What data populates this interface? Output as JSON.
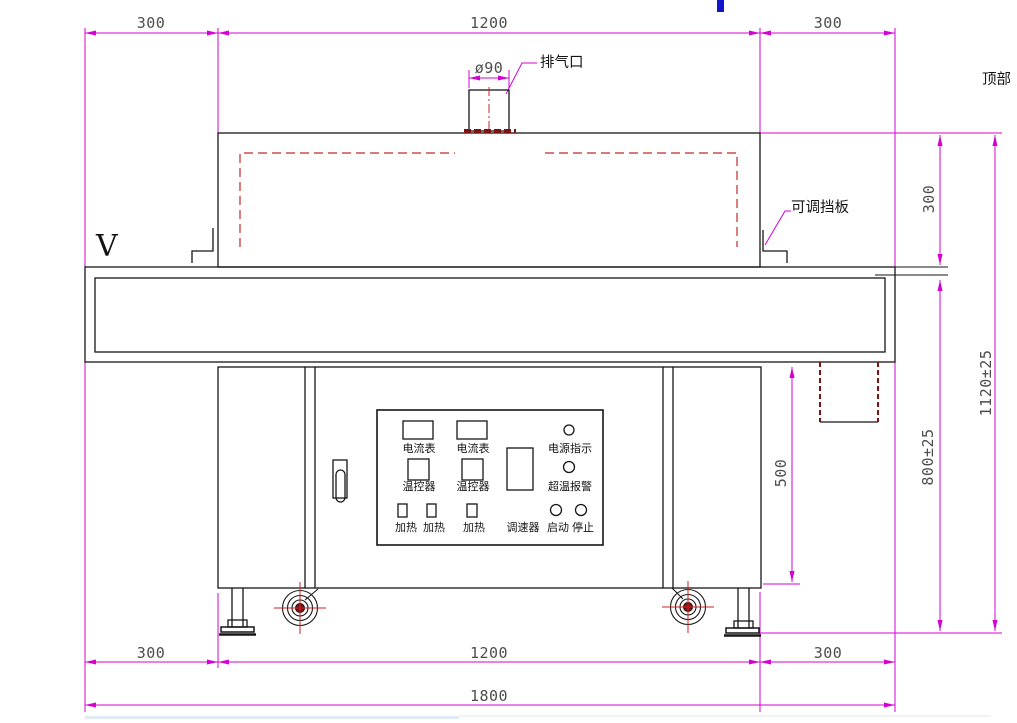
{
  "drawing": {
    "view_label": "V",
    "top_label": "顶部",
    "callouts": {
      "exhaust": "排气口",
      "baffle": "可调挡板"
    },
    "dimensions": {
      "top_left": "300",
      "top_center": "1200",
      "top_right": "300",
      "chimney_dia": "ø90",
      "side_hood_height": "300",
      "side_total_height": "1120±25",
      "side_work_height": "800±25",
      "side_cabinet_height": "500",
      "bottom_left": "300",
      "bottom_center": "1200",
      "bottom_right": "300",
      "bottom_total": "1800"
    },
    "panel": {
      "ammeter_1": "电流表",
      "ammeter_2": "电流表",
      "power_indicator": "电源指示",
      "temp_controller_1": "温控器",
      "temp_controller_2": "温控器",
      "overtemp_alarm": "超温报警",
      "heater_1": "加热",
      "heater_2": "加热",
      "heater_3": "加热",
      "speed_controller": "调速器",
      "start": "启动",
      "stop": "停止"
    },
    "colors": {
      "dimension_line": "#d400d4",
      "dimension_text": "#4d4d4d",
      "outline": "#161616",
      "dashed_red": "#c02a2a",
      "dark_red": "#7c1414",
      "crosshair_red": "#cc2020",
      "blue_marker": "#1414c8"
    }
  }
}
